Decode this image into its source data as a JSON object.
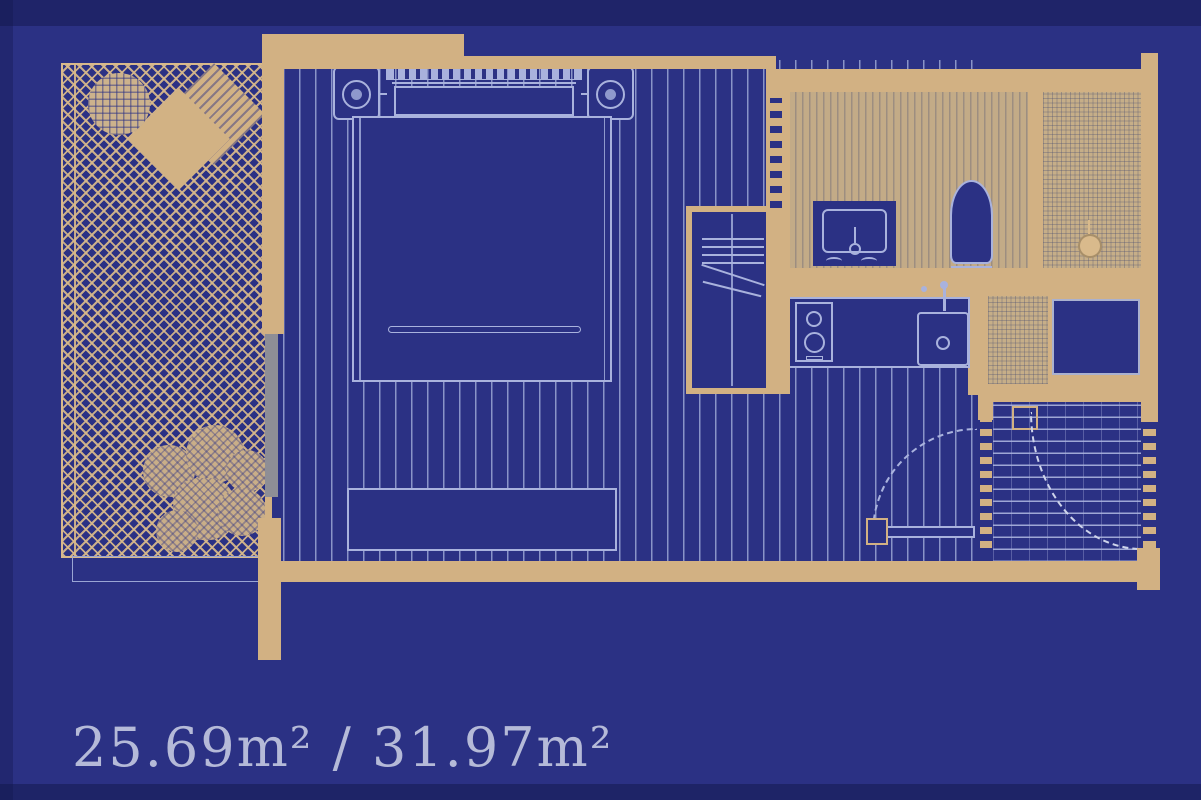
{
  "floorplan": {
    "area_label": "25.69m² / 31.97m²",
    "features": [
      "balcony-terrace",
      "round-table",
      "lounge-chair",
      "plant",
      "double-bed",
      "headboard",
      "pillow",
      "nightstand-left",
      "nightstand-right",
      "lamp-left",
      "lamp-right",
      "foot-bench",
      "wardrobe",
      "hanger-rod",
      "bathroom",
      "vanity-sink",
      "toilet",
      "shower",
      "shower-drain",
      "kitchen-counter",
      "cooktop",
      "kitchen-sink",
      "washer",
      "utility-niche",
      "hall-door-swing",
      "entry-door-swing",
      "entry-mat",
      "sliding-door"
    ],
    "colors": {
      "background": "#2b3184",
      "wall": "#d2b183",
      "furniture_line": "#a9b2dd",
      "label_text": "#b5bad8",
      "glass_gray": "#8e8e96"
    }
  }
}
